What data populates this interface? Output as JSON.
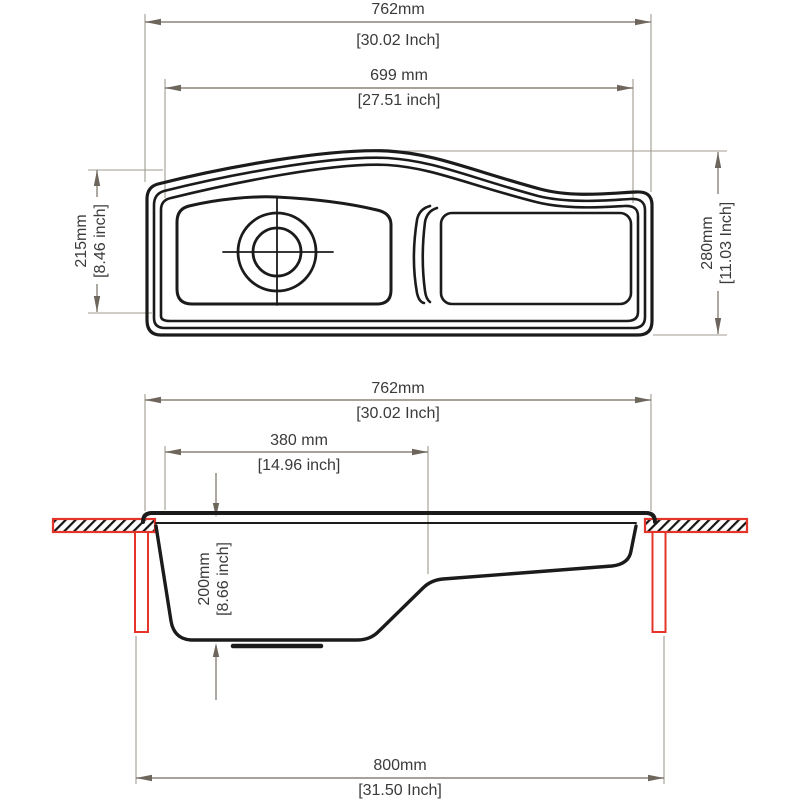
{
  "drawing_title": "sink-technical-drawing",
  "top_view": {
    "width_overall": {
      "mm": "762mm",
      "inch": "[30.02 Inch]"
    },
    "width_inner": {
      "mm": "699 mm",
      "inch": "[27.51 inch]"
    },
    "bowl_front_to_back": {
      "mm": "215mm",
      "inch": "[8.46 inch]"
    },
    "overall_front_to_back": {
      "mm": "280mm",
      "inch": "[11.03 Inch]"
    }
  },
  "side_view": {
    "width_overall": {
      "mm": "762mm",
      "inch": "[30.02 Inch]"
    },
    "bowl_width": {
      "mm": "380 mm",
      "inch": "[14.96 inch]"
    },
    "bowl_depth": {
      "mm": "200mm",
      "inch": "[8.66 inch]"
    },
    "overall_with_counter": {
      "mm": "800mm",
      "inch": "[31.50 Inch]"
    }
  },
  "colors": {
    "line": "#1b1b1b",
    "dimension_line": "#8b8279",
    "extension_line": "#a09a90",
    "arrow": "#6e665c",
    "counter_red": "#e5352b",
    "text": "#3a3a3a"
  }
}
